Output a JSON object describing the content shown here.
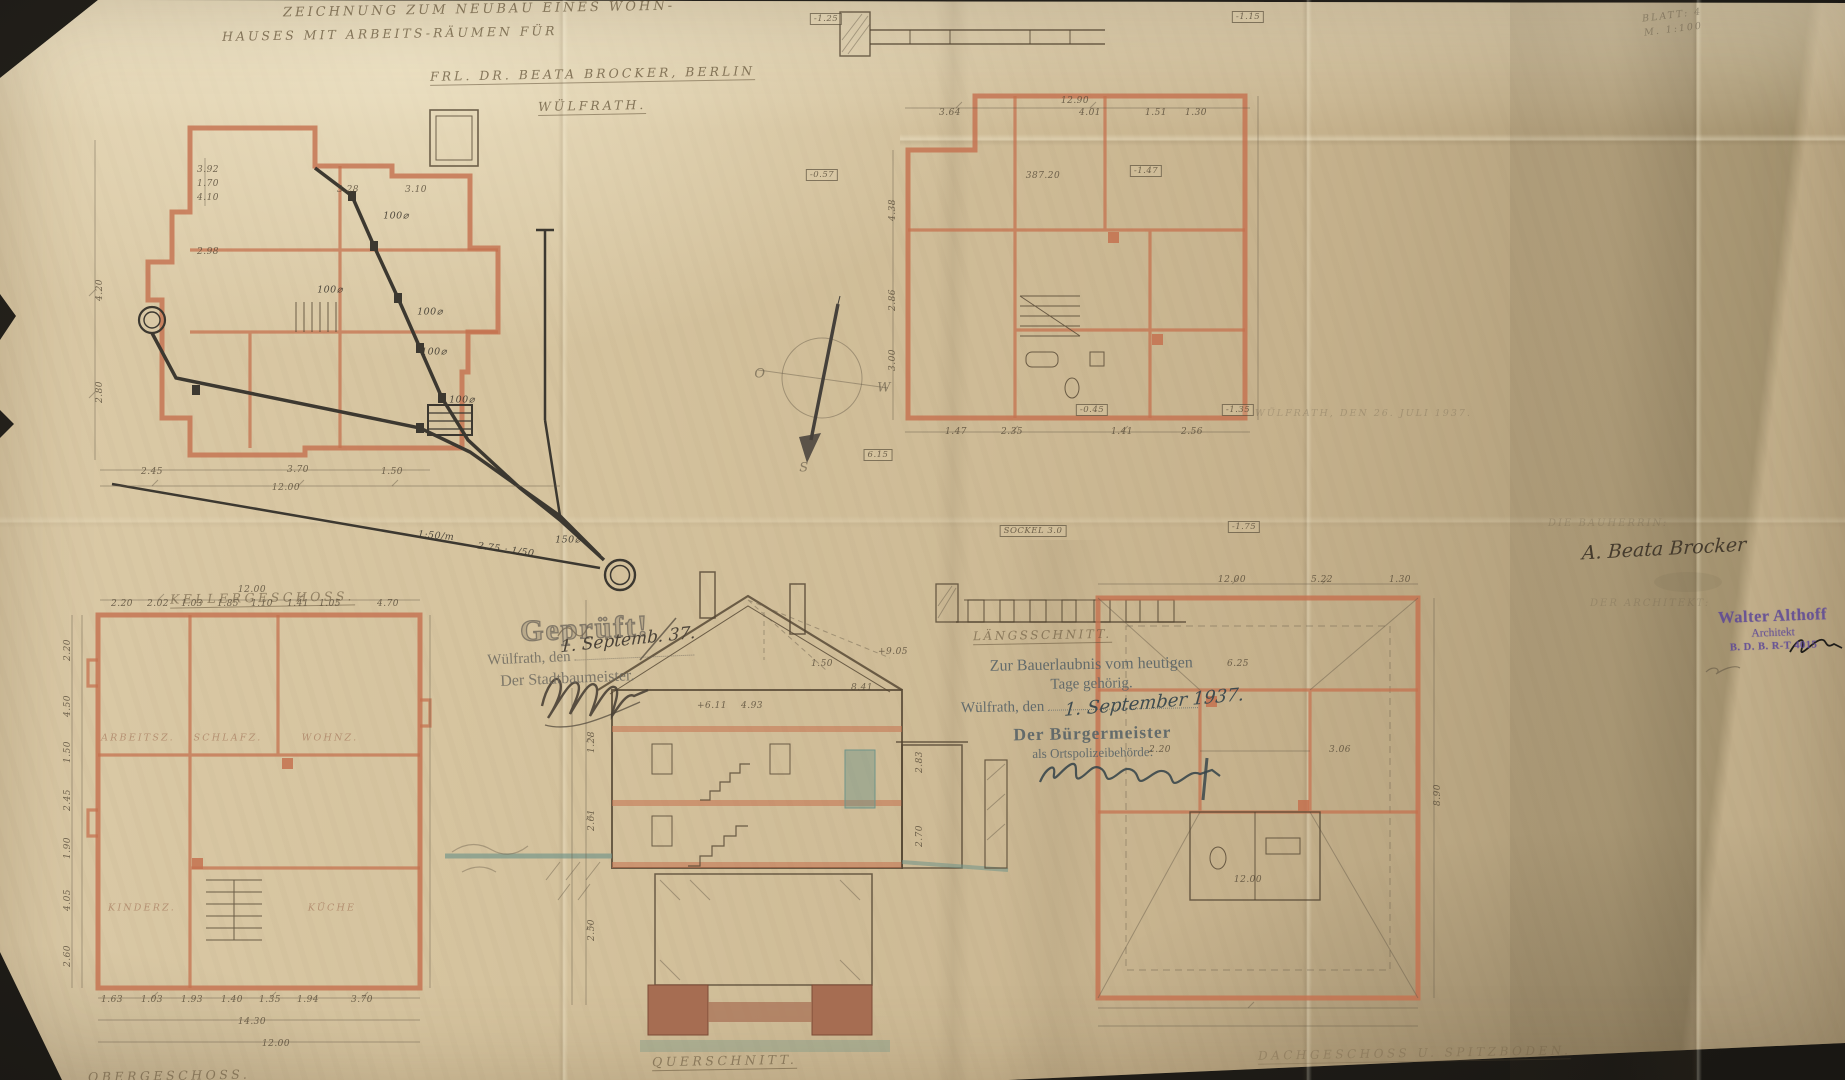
{
  "colors": {
    "backdrop": "#201d18",
    "paper": "#cfbd98",
    "wall_salmon": "#c4714f",
    "ink": "#5d4f3c",
    "pipe_ink": "#3c3830",
    "ground_teal": "#6f9488",
    "stamp_grey": "#6e6a60",
    "stamp_blue": "#5b6568",
    "stamp_purple": "#5c4798"
  },
  "title_block": {
    "line1": "ZEICHNUNG ZUM NEUBAU EINES WOHN-",
    "line2": "HAUSES MIT ARBEITS-RÄUMEN FÜR",
    "line3": "FRL. DR. BEATA BROCKER, BERLIN",
    "line4": "WÜLFRATH."
  },
  "sheet_info": {
    "sheet": "BLATT: 4",
    "scale": "M. 1:100"
  },
  "plan_labels": {
    "drainage": "KELLERGESCHOSS.",
    "strip": "LÄNGSSCHNITT.",
    "lower_left": "OBERGESCHOSS.",
    "section": "QUERSCHNITT.",
    "attic": "DACHGESCHOSS U. SPITZBODEN."
  },
  "stamps": {
    "geprueft": {
      "title": "Geprüft!",
      "place": "Wülfrath, den",
      "officer": "Der Stadtbaumeister.",
      "handwritten_date": "1. Septemb. 37."
    },
    "bauerlaubnis": {
      "line1": "Zur Bauerlaubnis vom heutigen",
      "line2": "Tage gehörig.",
      "place": "Wülfrath, den",
      "officer": "Der Bürgermeister",
      "officer2": "als Ortspolizeibehörde:",
      "handwritten_date": "1. September 1937."
    },
    "architect": {
      "name": "Walter Althoff",
      "title": "Architekt",
      "registration": "B. D. B.  R-T 4015"
    }
  },
  "inscriptions": {
    "date_note": "WÜLFRATH, DEN 26. JULI 1937.",
    "client_caption": "DIE BAUHERRIN:",
    "client_signature": "A. Beata Brocker",
    "architect_caption": "DER ARCHITEKT:"
  },
  "compass": {
    "east": "O",
    "west": "W",
    "south": "S"
  },
  "annotations": {
    "drainage": [
      {
        "t": "3.92",
        "x": 208,
        "y": 170
      },
      {
        "t": "1.70",
        "x": 208,
        "y": 184
      },
      {
        "t": "4.10",
        "x": 208,
        "y": 198
      },
      {
        "t": "3.28",
        "x": 348,
        "y": 190
      },
      {
        "t": "3.10",
        "x": 416,
        "y": 190
      },
      {
        "t": "2.98",
        "x": 208,
        "y": 252
      },
      {
        "t": "4.20",
        "x": 100,
        "y": 290,
        "r": -90
      },
      {
        "t": "2.80",
        "x": 100,
        "y": 392,
        "r": -90
      },
      {
        "t": "2.45",
        "x": 152,
        "y": 472
      },
      {
        "t": "3.70",
        "x": 298,
        "y": 470
      },
      {
        "t": "1.50",
        "x": 392,
        "y": 472
      },
      {
        "t": "12.00",
        "x": 286,
        "y": 488
      },
      {
        "t": "100⌀",
        "x": 396,
        "y": 216,
        "k": "pipe-label"
      },
      {
        "t": "100⌀",
        "x": 330,
        "y": 290,
        "k": "pipe-label"
      },
      {
        "t": "100⌀",
        "x": 430,
        "y": 312,
        "k": "pipe-label"
      },
      {
        "t": "100⌀",
        "x": 434,
        "y": 352,
        "k": "pipe-label"
      },
      {
        "t": "100⌀",
        "x": 462,
        "y": 400,
        "k": "pipe-label"
      },
      {
        "t": "150⌀",
        "x": 568,
        "y": 540,
        "k": "pipe-label"
      },
      {
        "t": "2.75 : 1/50",
        "x": 506,
        "y": 550,
        "k": "pipe-label",
        "r": 8
      },
      {
        "t": "1:50/m",
        "x": 436,
        "y": 536,
        "k": "pipe-label",
        "r": 5
      }
    ],
    "upper_right": [
      {
        "t": "-1.25",
        "x": 826,
        "y": 19,
        "b": 1
      },
      {
        "t": "-1.15",
        "x": 1248,
        "y": 17,
        "b": 1
      },
      {
        "t": "-0.57",
        "x": 822,
        "y": 175,
        "b": 1
      },
      {
        "t": "-1.47",
        "x": 1146,
        "y": 171,
        "b": 1
      },
      {
        "t": "-0.45",
        "x": 1092,
        "y": 410,
        "b": 1
      },
      {
        "t": "-1.35",
        "x": 1238,
        "y": 410,
        "b": 1
      },
      {
        "t": "-1.75",
        "x": 1244,
        "y": 527,
        "b": 1
      },
      {
        "t": "387.20",
        "x": 1043,
        "y": 176
      },
      {
        "t": "6.15",
        "x": 878,
        "y": 455,
        "b": 1
      },
      {
        "t": "SOCKEL 3.0",
        "x": 1033,
        "y": 531,
        "b": 1
      },
      {
        "t": "12.90",
        "x": 1075,
        "y": 101
      },
      {
        "t": "3.64",
        "x": 950,
        "y": 113
      },
      {
        "t": "4.01",
        "x": 1090,
        "y": 113
      },
      {
        "t": "1.51",
        "x": 1156,
        "y": 113
      },
      {
        "t": "1.30",
        "x": 1196,
        "y": 113
      },
      {
        "t": "4.38",
        "x": 893,
        "y": 210,
        "r": -90
      },
      {
        "t": "2.86",
        "x": 893,
        "y": 300,
        "r": -90
      },
      {
        "t": "3.00",
        "x": 893,
        "y": 360,
        "r": -90
      },
      {
        "t": "1.47",
        "x": 956,
        "y": 432
      },
      {
        "t": "2.35",
        "x": 1012,
        "y": 432
      },
      {
        "t": "1.41",
        "x": 1122,
        "y": 432
      },
      {
        "t": "2.56",
        "x": 1192,
        "y": 432
      }
    ],
    "lower_left": [
      {
        "t": "12.00",
        "x": 252,
        "y": 590
      },
      {
        "t": "2.20",
        "x": 122,
        "y": 604
      },
      {
        "t": "2.02",
        "x": 158,
        "y": 604
      },
      {
        "t": "1.03",
        "x": 192,
        "y": 604
      },
      {
        "t": "1.85",
        "x": 228,
        "y": 604
      },
      {
        "t": "1.10",
        "x": 262,
        "y": 604
      },
      {
        "t": "1.41",
        "x": 298,
        "y": 604
      },
      {
        "t": "1.05",
        "x": 330,
        "y": 604
      },
      {
        "t": "4.70",
        "x": 388,
        "y": 604
      },
      {
        "t": "2.20",
        "x": 68,
        "y": 650,
        "r": -90
      },
      {
        "t": "4.50",
        "x": 68,
        "y": 706,
        "r": -90
      },
      {
        "t": "1.50",
        "x": 68,
        "y": 752,
        "r": -90
      },
      {
        "t": "2.45",
        "x": 68,
        "y": 800,
        "r": -90
      },
      {
        "t": "1.90",
        "x": 68,
        "y": 848,
        "r": -90
      },
      {
        "t": "4.05",
        "x": 68,
        "y": 900,
        "r": -90
      },
      {
        "t": "2.60",
        "x": 68,
        "y": 956,
        "r": -90
      },
      {
        "t": "1.63",
        "x": 112,
        "y": 1000
      },
      {
        "t": "1.03",
        "x": 152,
        "y": 1000
      },
      {
        "t": "1.93",
        "x": 192,
        "y": 1000
      },
      {
        "t": "1.40",
        "x": 232,
        "y": 1000
      },
      {
        "t": "1.35",
        "x": 270,
        "y": 1000
      },
      {
        "t": "1.94",
        "x": 308,
        "y": 1000
      },
      {
        "t": "3.70",
        "x": 362,
        "y": 1000
      },
      {
        "t": "14.30",
        "x": 252,
        "y": 1022
      },
      {
        "t": "12.00",
        "x": 276,
        "y": 1044
      },
      {
        "t": "ARBEITSZ.",
        "x": 138,
        "y": 738,
        "k": "room"
      },
      {
        "t": "SCHLAFZ.",
        "x": 228,
        "y": 738,
        "k": "room"
      },
      {
        "t": "WOHNZ.",
        "x": 330,
        "y": 738,
        "k": "room"
      },
      {
        "t": "KINDERZ.",
        "x": 142,
        "y": 908,
        "k": "room"
      },
      {
        "t": "KÜCHE",
        "x": 332,
        "y": 908,
        "k": "room"
      }
    ],
    "section": [
      {
        "t": "+9.05",
        "x": 893,
        "y": 652
      },
      {
        "t": "8.41",
        "x": 862,
        "y": 688
      },
      {
        "t": "1.50",
        "x": 822,
        "y": 664
      },
      {
        "t": "+6.11",
        "x": 712,
        "y": 706
      },
      {
        "t": "4.93",
        "x": 752,
        "y": 706
      },
      {
        "t": "2.83",
        "x": 920,
        "y": 762,
        "r": -90
      },
      {
        "t": "2.70",
        "x": 920,
        "y": 836,
        "r": -90
      },
      {
        "t": "1.28",
        "x": 592,
        "y": 742,
        "r": -90
      },
      {
        "t": "2.61",
        "x": 592,
        "y": 820,
        "r": -90
      },
      {
        "t": "2.50",
        "x": 592,
        "y": 930,
        "r": -90
      }
    ],
    "attic": [
      {
        "t": "12.00",
        "x": 1232,
        "y": 580
      },
      {
        "t": "5.22",
        "x": 1322,
        "y": 580
      },
      {
        "t": "1.30",
        "x": 1400,
        "y": 580
      },
      {
        "t": "6.25",
        "x": 1238,
        "y": 664
      },
      {
        "t": "2.20",
        "x": 1160,
        "y": 750
      },
      {
        "t": "3.06",
        "x": 1340,
        "y": 750
      },
      {
        "t": "12.00",
        "x": 1248,
        "y": 880
      },
      {
        "t": "8.90",
        "x": 1438,
        "y": 795,
        "r": -90
      }
    ],
    "compass_letters": [
      {
        "t": "O",
        "x": 760,
        "y": 374,
        "k": "compass"
      },
      {
        "t": "W",
        "x": 884,
        "y": 388,
        "k": "compass"
      },
      {
        "t": "S",
        "x": 804,
        "y": 468,
        "k": "compass"
      }
    ]
  }
}
